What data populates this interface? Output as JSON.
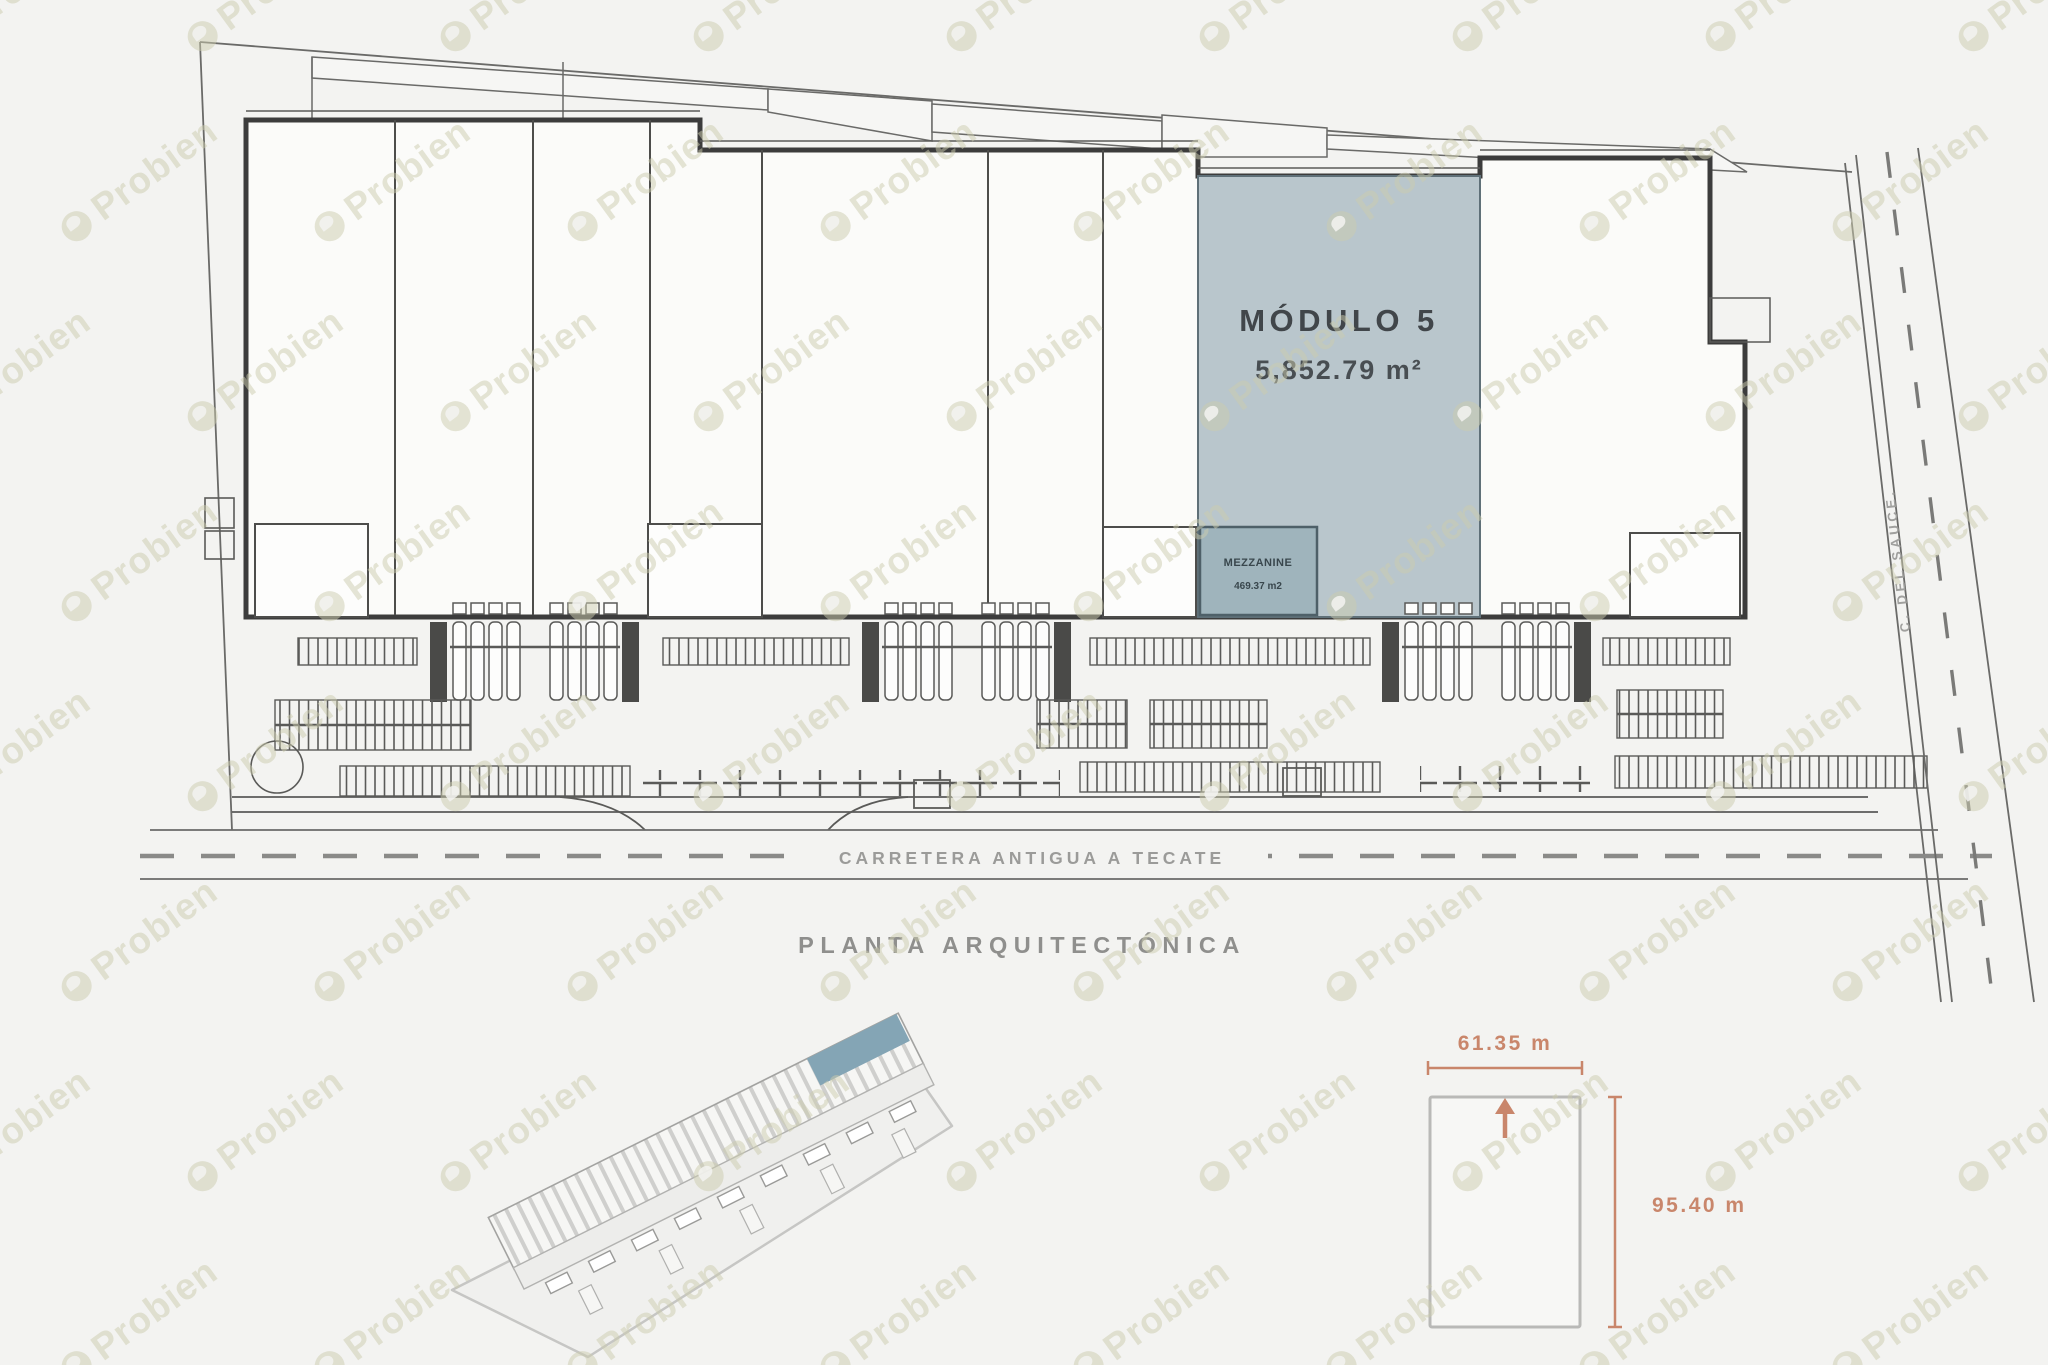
{
  "watermark": {
    "text": "Probien"
  },
  "plan": {
    "title": "PLANTA ARQUITECTÓNICA",
    "module5": {
      "name": "MÓDULO 5",
      "area": "5,852.79 m²"
    },
    "mezzanine": {
      "name": "MEZZANINE",
      "area": "469.37 m2"
    },
    "road_bottom": "CARRETERA ANTIGUA A TECATE",
    "road_right": "C. DEL SAUCE."
  },
  "dimension_diagram": {
    "width_label": "61.35 m",
    "height_label": "95.40 m"
  },
  "colors": {
    "module5_fill": "#b9c6cc",
    "mezzanine_fill": "#9fb4bc",
    "accent": "#c9866b",
    "line_thin": "#5a5a58",
    "line_thick": "#3c3c3c",
    "watermark": "#cbcbad"
  }
}
